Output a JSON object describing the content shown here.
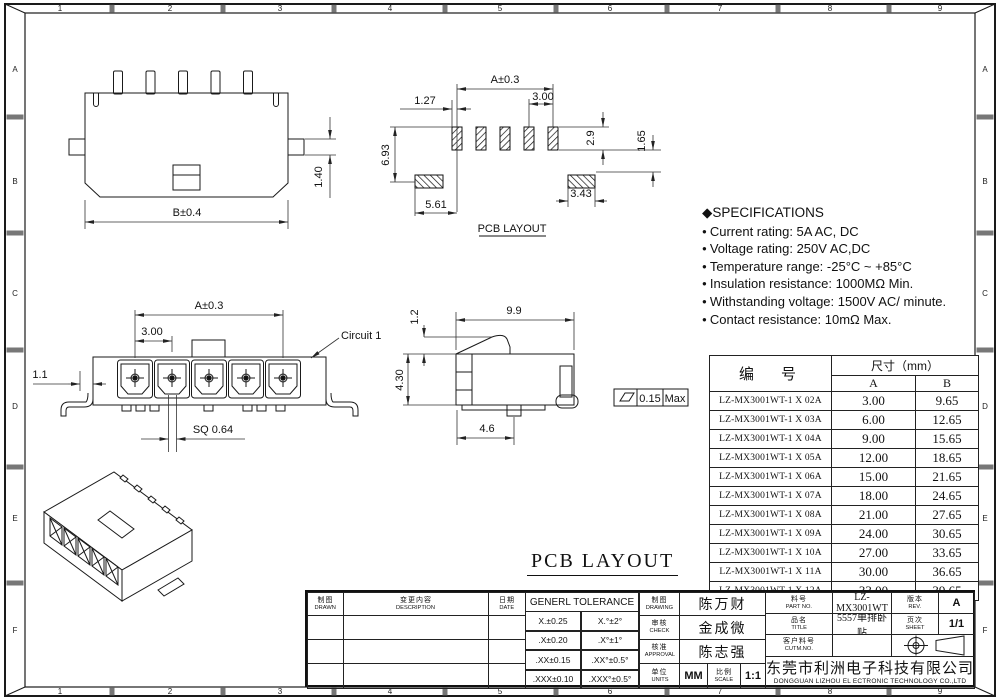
{
  "border": {
    "top_numbers": [
      "1",
      "2",
      "3",
      "4",
      "5",
      "6",
      "7",
      "8",
      "9"
    ],
    "bottom_numbers": [
      "1",
      "2",
      "3",
      "4",
      "5",
      "6",
      "7",
      "8",
      "9"
    ],
    "left_letters": [
      "A",
      "B",
      "C",
      "D",
      "E",
      "F"
    ],
    "right_letters": [
      "A",
      "B",
      "C",
      "D",
      "E",
      "F"
    ]
  },
  "views": {
    "rear": {
      "dim_width": "B±0.4",
      "dim_tab": "1.40"
    },
    "pcb_top": {
      "dim_a": "A±0.3",
      "d127": "1.27",
      "d300": "3.00",
      "d693": "6.93",
      "d29": "2.9",
      "d165": "1.65",
      "d561": "5.61",
      "d343": "3.43",
      "label": "PCB LAYOUT"
    },
    "front": {
      "dim_a": "A±0.3",
      "dim_pitch": "3.00",
      "dim_offset": "1.1",
      "dim_sq": "SQ 0.64",
      "circuit": "Circuit 1"
    },
    "side": {
      "d99": "9.9",
      "d12": "1.2",
      "d430": "4.30",
      "d46": "4.6",
      "flat_val": "0.15",
      "flat_max": "Max"
    },
    "pcb_large_label": "PCB LAYOUT"
  },
  "specs": {
    "marker": "◆",
    "title": "SPECIFICATIONS",
    "bullet": "●",
    "items": [
      "Current rating: 5A AC, DC",
      "Voltage rating: 250V AC,DC",
      "Temperature range: -25°C ~ +85°C",
      "Insulation resistance: 1000MΩ Min.",
      "Withstanding voltage: 1500V AC/ minute.",
      "Contact resistance: 10mΩ Max."
    ]
  },
  "parts_table": {
    "header_part": "编　号",
    "header_size": "尺寸（mm）",
    "col_a": "A",
    "col_b": "B",
    "rows": [
      {
        "part": "LZ-MX3001WT-1 X 02A",
        "a": "3.00",
        "b": "9.65"
      },
      {
        "part": "LZ-MX3001WT-1 X 03A",
        "a": "6.00",
        "b": "12.65"
      },
      {
        "part": "LZ-MX3001WT-1 X 04A",
        "a": "9.00",
        "b": "15.65"
      },
      {
        "part": "LZ-MX3001WT-1 X 05A",
        "a": "12.00",
        "b": "18.65"
      },
      {
        "part": "LZ-MX3001WT-1 X 06A",
        "a": "15.00",
        "b": "21.65"
      },
      {
        "part": "LZ-MX3001WT-1 X 07A",
        "a": "18.00",
        "b": "24.65"
      },
      {
        "part": "LZ-MX3001WT-1 X 08A",
        "a": "21.00",
        "b": "27.65"
      },
      {
        "part": "LZ-MX3001WT-1 X 09A",
        "a": "24.00",
        "b": "30.65"
      },
      {
        "part": "LZ-MX3001WT-1 X 10A",
        "a": "27.00",
        "b": "33.65"
      },
      {
        "part": "LZ-MX3001WT-1 X 11A",
        "a": "30.00",
        "b": "36.65"
      },
      {
        "part": "LZ-MX3001WT-1 X 12A",
        "a": "33.00",
        "b": "39.65"
      }
    ]
  },
  "title_block": {
    "drawn_cn": "制图",
    "drawn_en": "DRAWN",
    "desc_cn": "变更内容",
    "desc_en": "DESCRIPTION",
    "date_cn": "日期",
    "date_en": "DATE",
    "tol_title": "GENERL TOLERANCE",
    "tol_rows": [
      [
        "X.±0.25",
        "X.°±2°"
      ],
      [
        ".X±0.20",
        ".X°±1°"
      ],
      [
        ".XX±0.15",
        ".XX°±0.5°"
      ],
      [
        ".XXX±0.10",
        ".XXX°±0.5°"
      ]
    ],
    "drawing_cn": "制图",
    "drawing_en": "DRAWING",
    "drawing_name": "陈万财",
    "check_cn": "审核",
    "check_en": "CHECK",
    "check_name": "金成微",
    "approval_cn": "核准",
    "approval_en": "APPROVAL",
    "approval_name": "陈志强",
    "units_cn": "单位",
    "units_en": "UNITS",
    "units_val": "MM",
    "scale_cn": "比例",
    "scale_en": "SCALE",
    "scale_val": "1:1",
    "part_cn": "料号",
    "part_en": "PART NO.",
    "part_val": "LZ-MX3001WT",
    "title_cn": "品名",
    "title_en": "TITLE",
    "title_val": "5557单排卧贴",
    "cust_cn": "客户料号",
    "cust_en": "CUTM.NO.",
    "cust_val": "",
    "rev_cn": "版本",
    "rev_en": "REV.",
    "rev_val": "A",
    "sheet_cn": "页次",
    "sheet_en": "SHEET",
    "sheet_val": "1/1",
    "company_cn": "东莞市利洲电子科技有限公司",
    "company_en": "DONGGUAN LIZHOU EL ECTRONIC TECHNOLOGY CO.,LTD"
  }
}
